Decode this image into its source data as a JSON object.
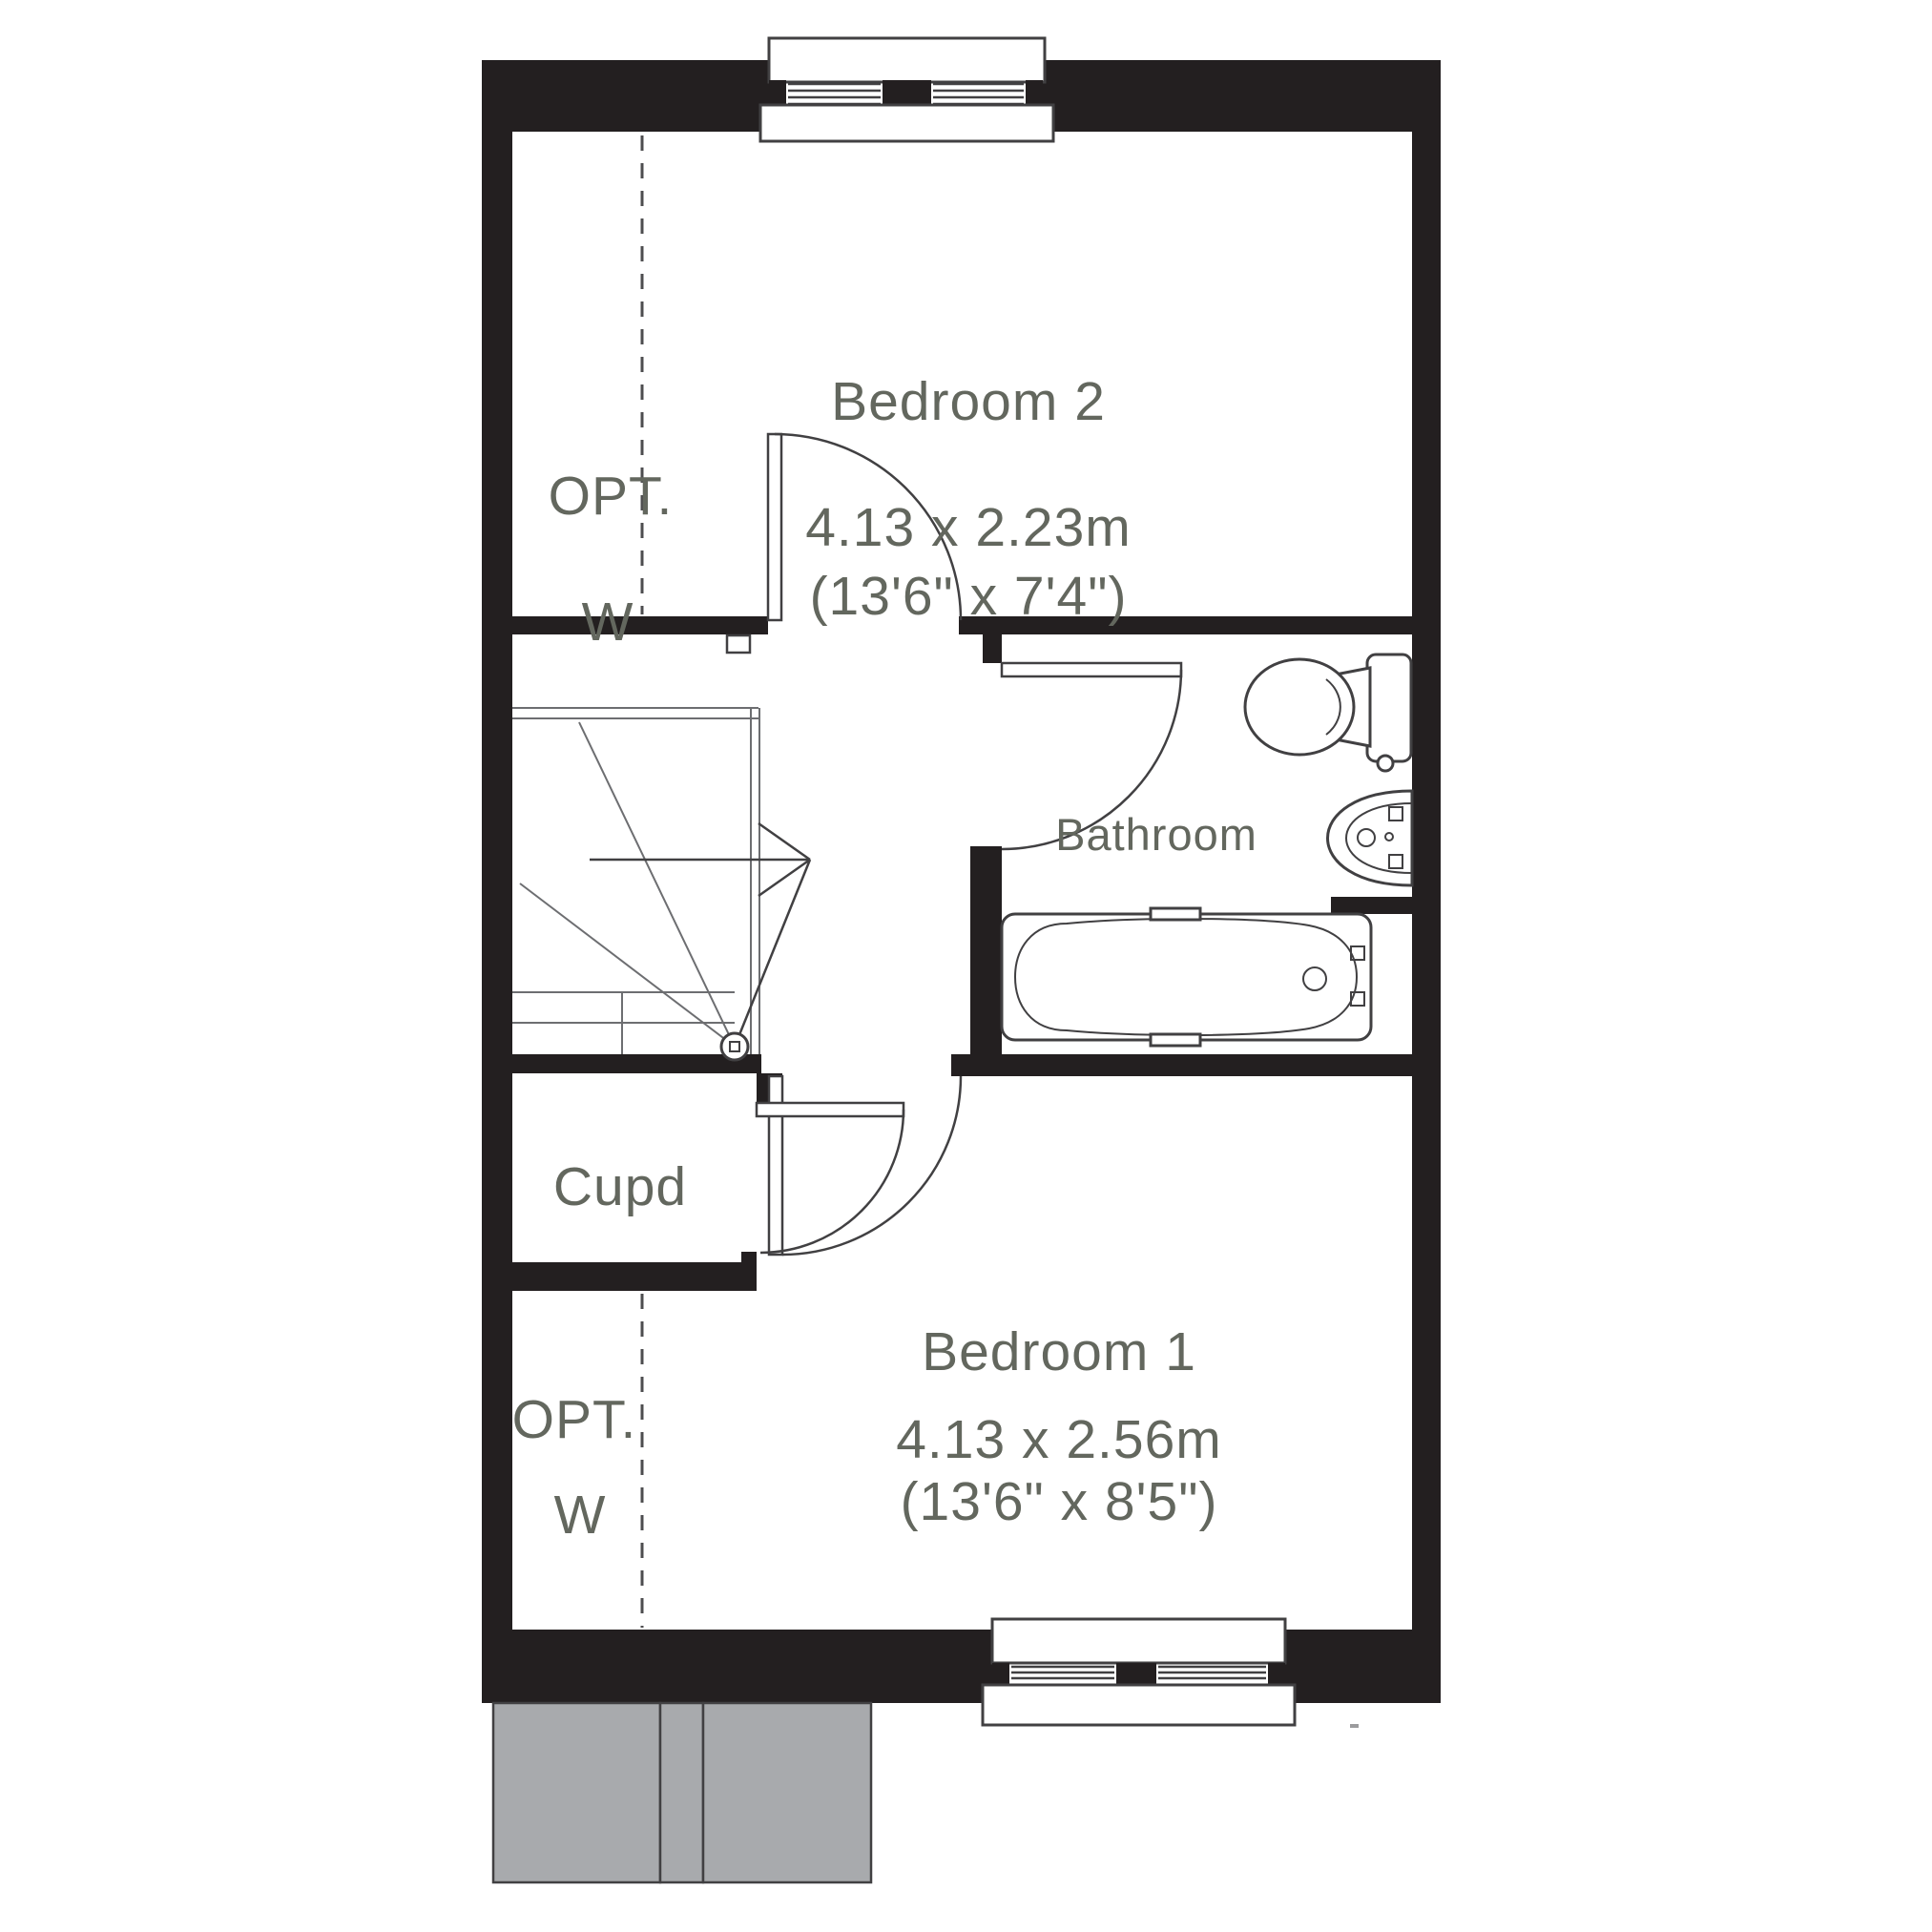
{
  "colors": {
    "wall": "#231f20",
    "label_text": "#63675e",
    "line": "#414042",
    "gray_block_fill": "#a8aaad",
    "background": "#ffffff"
  },
  "rooms": {
    "bedroom2": {
      "name": "Bedroom 2",
      "size_metric": "4.13 x 2.23m",
      "size_imperial": "(13'6\" x 7'4\")"
    },
    "bedroom1": {
      "name": "Bedroom 1",
      "size_metric": "4.13 x 2.56m",
      "size_imperial": "(13'6\" x 8'5\")"
    },
    "bathroom": {
      "name": "Bathroom"
    },
    "cupboard": {
      "name": "Cupd"
    },
    "opt_wardrobe_bedroom2": {
      "abbr": "OPT.",
      "letter": "W"
    },
    "opt_wardrobe_bedroom1": {
      "abbr": "OPT.",
      "letter": "W"
    }
  },
  "fixtures": {
    "stairs": "staircase with winders and up-arrow",
    "bath": "bathtub",
    "toilet": "toilet with cistern",
    "basin": "wash-basin",
    "windows": [
      "top exterior window",
      "bottom exterior window"
    ],
    "doors": [
      "bedroom2-door",
      "bathroom-door",
      "bedroom1-door",
      "cupboard-door"
    ]
  }
}
